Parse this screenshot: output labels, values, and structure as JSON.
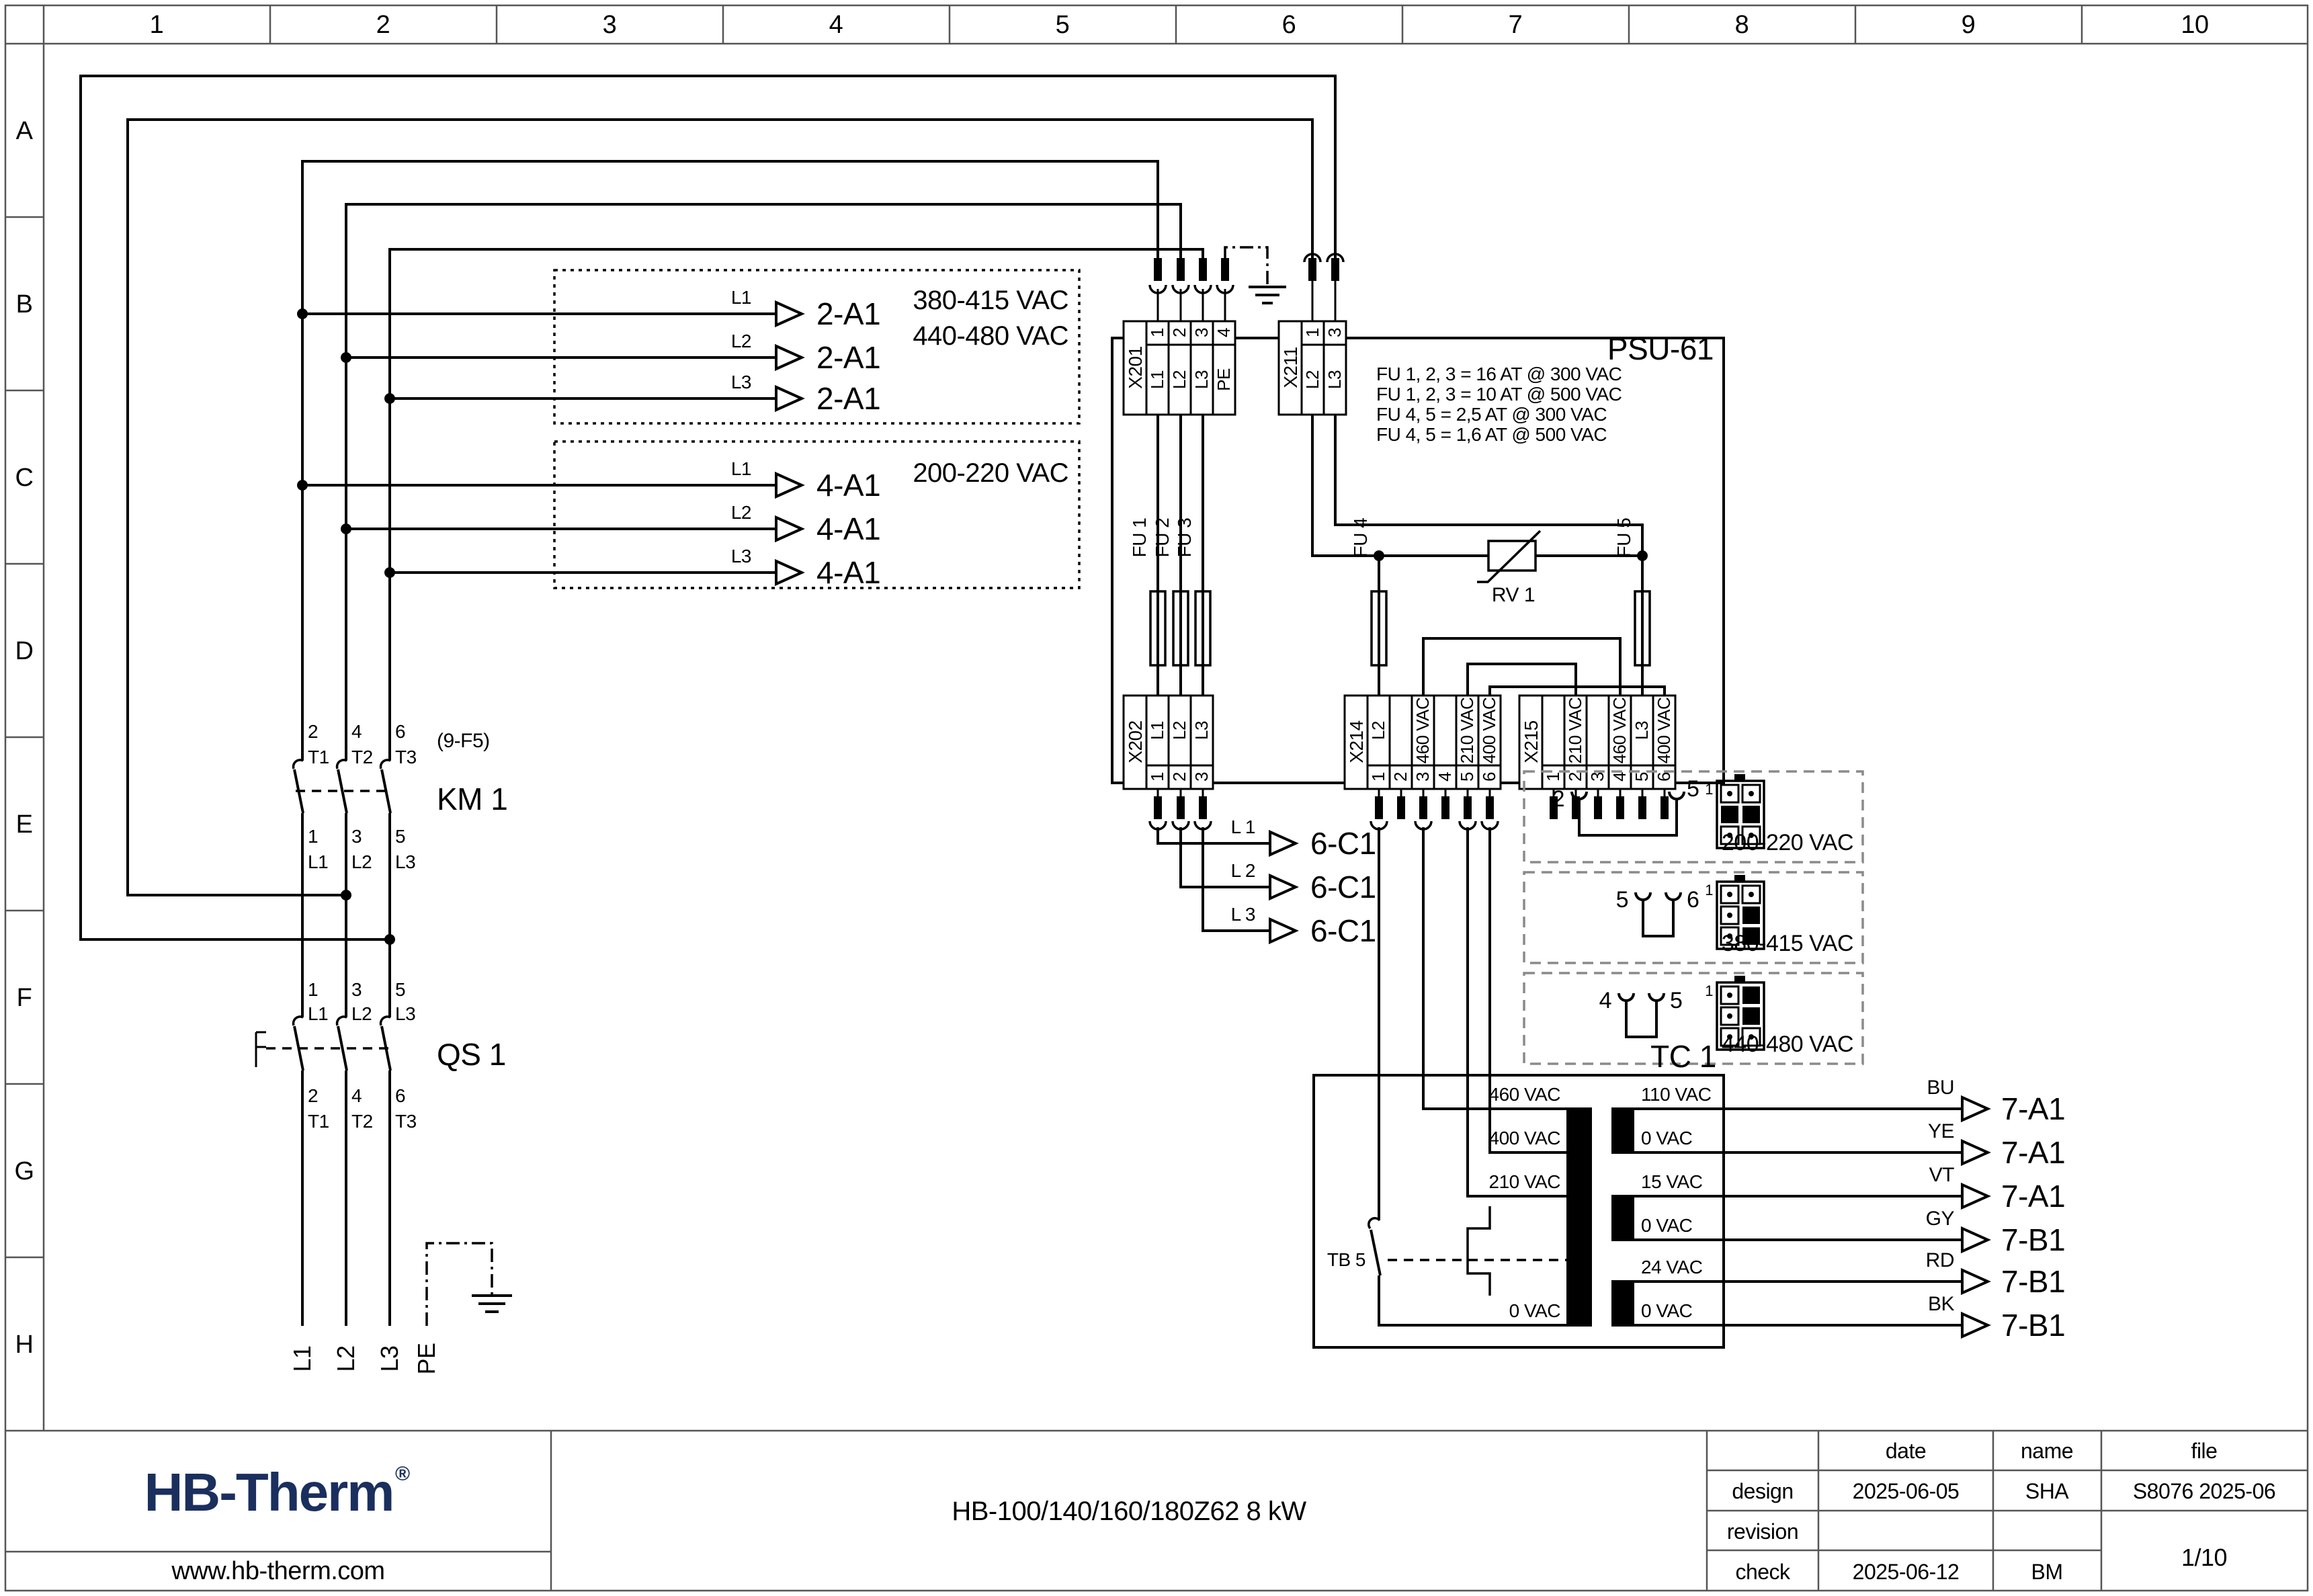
{
  "grid": {
    "cols": [
      "1",
      "2",
      "3",
      "4",
      "5",
      "6",
      "7",
      "8",
      "9",
      "10"
    ],
    "rows": [
      "A",
      "B",
      "C",
      "D",
      "E",
      "F",
      "G",
      "H"
    ]
  },
  "feeds": {
    "box1": {
      "voltage1": "380-415 VAC",
      "voltage2": "440-480 VAC",
      "phases": [
        "L1",
        "L2",
        "L3"
      ],
      "target": "2-A1"
    },
    "box2": {
      "voltage": "200-220 VAC",
      "phases": [
        "L1",
        "L2",
        "L3"
      ],
      "target": "4-A1"
    }
  },
  "psu": {
    "name": "PSU-61",
    "notes": [
      "FU 1, 2, 3 = 16 AT @ 300 VAC",
      "FU 1, 2, 3 = 10 AT @ 500 VAC",
      "FU 4, 5 = 2,5 AT @ 300 VAC",
      "FU 4, 5 = 1,6 AT @ 500 VAC"
    ],
    "x201": {
      "name": "X201",
      "nums": [
        "1",
        "2",
        "3",
        "4"
      ],
      "labels": [
        "L1",
        "L2",
        "L3",
        "PE"
      ]
    },
    "x211": {
      "name": "X211",
      "nums": [
        "1",
        "3"
      ],
      "labels": [
        "L2",
        "L3"
      ]
    },
    "x202": {
      "name": "X202",
      "nums": [
        "1",
        "2",
        "3"
      ],
      "labels": [
        "L1",
        "L2",
        "L3"
      ]
    },
    "x214": {
      "name": "X214",
      "nums": [
        "1",
        "2",
        "3",
        "4",
        "5",
        "6"
      ],
      "labels": [
        "L2",
        "",
        "460 VAC",
        "",
        "210 VAC",
        "400 VAC"
      ]
    },
    "x215": {
      "name": "X215",
      "nums": [
        "1",
        "2",
        "3",
        "4",
        "5",
        "6"
      ],
      "labels": [
        "",
        "210 VAC",
        "",
        "460 VAC",
        "L3",
        "400 VAC"
      ]
    },
    "fu": [
      "FU 1",
      "FU 2",
      "FU 3",
      "FU 4",
      "FU 5"
    ],
    "rv": "RV 1"
  },
  "cable": {
    "phases": [
      "L 1",
      "L 2",
      "L 3"
    ],
    "target": "6-C1"
  },
  "km1": {
    "ref": "KM 1",
    "note": "(9-F5)",
    "top_nums": [
      "2",
      "4",
      "6"
    ],
    "top_lbls": [
      "T1",
      "T2",
      "T3"
    ],
    "bot_nums": [
      "1",
      "3",
      "5"
    ],
    "bot_lbls": [
      "L1",
      "L2",
      "L3"
    ]
  },
  "qs1": {
    "ref": "QS 1",
    "top_nums": [
      "1",
      "3",
      "5"
    ],
    "top_lbls": [
      "L1",
      "L2",
      "L3"
    ],
    "bot_nums": [
      "2",
      "4",
      "6"
    ],
    "bot_lbls": [
      "T1",
      "T2",
      "T3"
    ]
  },
  "supply": [
    "L1",
    "L2",
    "L3",
    "PE"
  ],
  "options": [
    {
      "a": "2",
      "b": "5",
      "voltage": "200-220 VAC",
      "pin1": "1"
    },
    {
      "a": "5",
      "b": "6",
      "voltage": "380-415 VAC",
      "pin1": "1"
    },
    {
      "a": "4",
      "b": "5",
      "voltage": "440-480 VAC",
      "pin1": "1"
    }
  ],
  "tc1": {
    "ref": "TC 1",
    "tb": "TB 5",
    "primary": [
      "460 VAC",
      "400 VAC",
      "210 VAC",
      "0 VAC"
    ],
    "secondary": [
      "110 VAC",
      "0 VAC",
      "15 VAC",
      "0 VAC",
      "24 VAC",
      "0 VAC"
    ]
  },
  "outputs": [
    {
      "color": "BU",
      "target": "7-A1"
    },
    {
      "color": "YE",
      "target": "7-A1"
    },
    {
      "color": "VT",
      "target": "7-A1"
    },
    {
      "color": "GY",
      "target": "7-B1"
    },
    {
      "color": "RD",
      "target": "7-B1"
    },
    {
      "color": "BK",
      "target": "7-B1"
    }
  ],
  "titleblock": {
    "logo": "HB-Therm",
    "reg": "®",
    "website": "www.hb-therm.com",
    "product": "HB-100/140/160/180Z62 8 kW",
    "col_date": "date",
    "col_name": "name",
    "col_file": "file",
    "row_design": "design",
    "row_revision": "revision",
    "row_check": "check",
    "design_date": "2025-06-05",
    "design_name": "SHA",
    "file_no": "S8076 2025-06",
    "check_date": "2025-06-12",
    "check_name": "BM",
    "page": "1/10"
  }
}
